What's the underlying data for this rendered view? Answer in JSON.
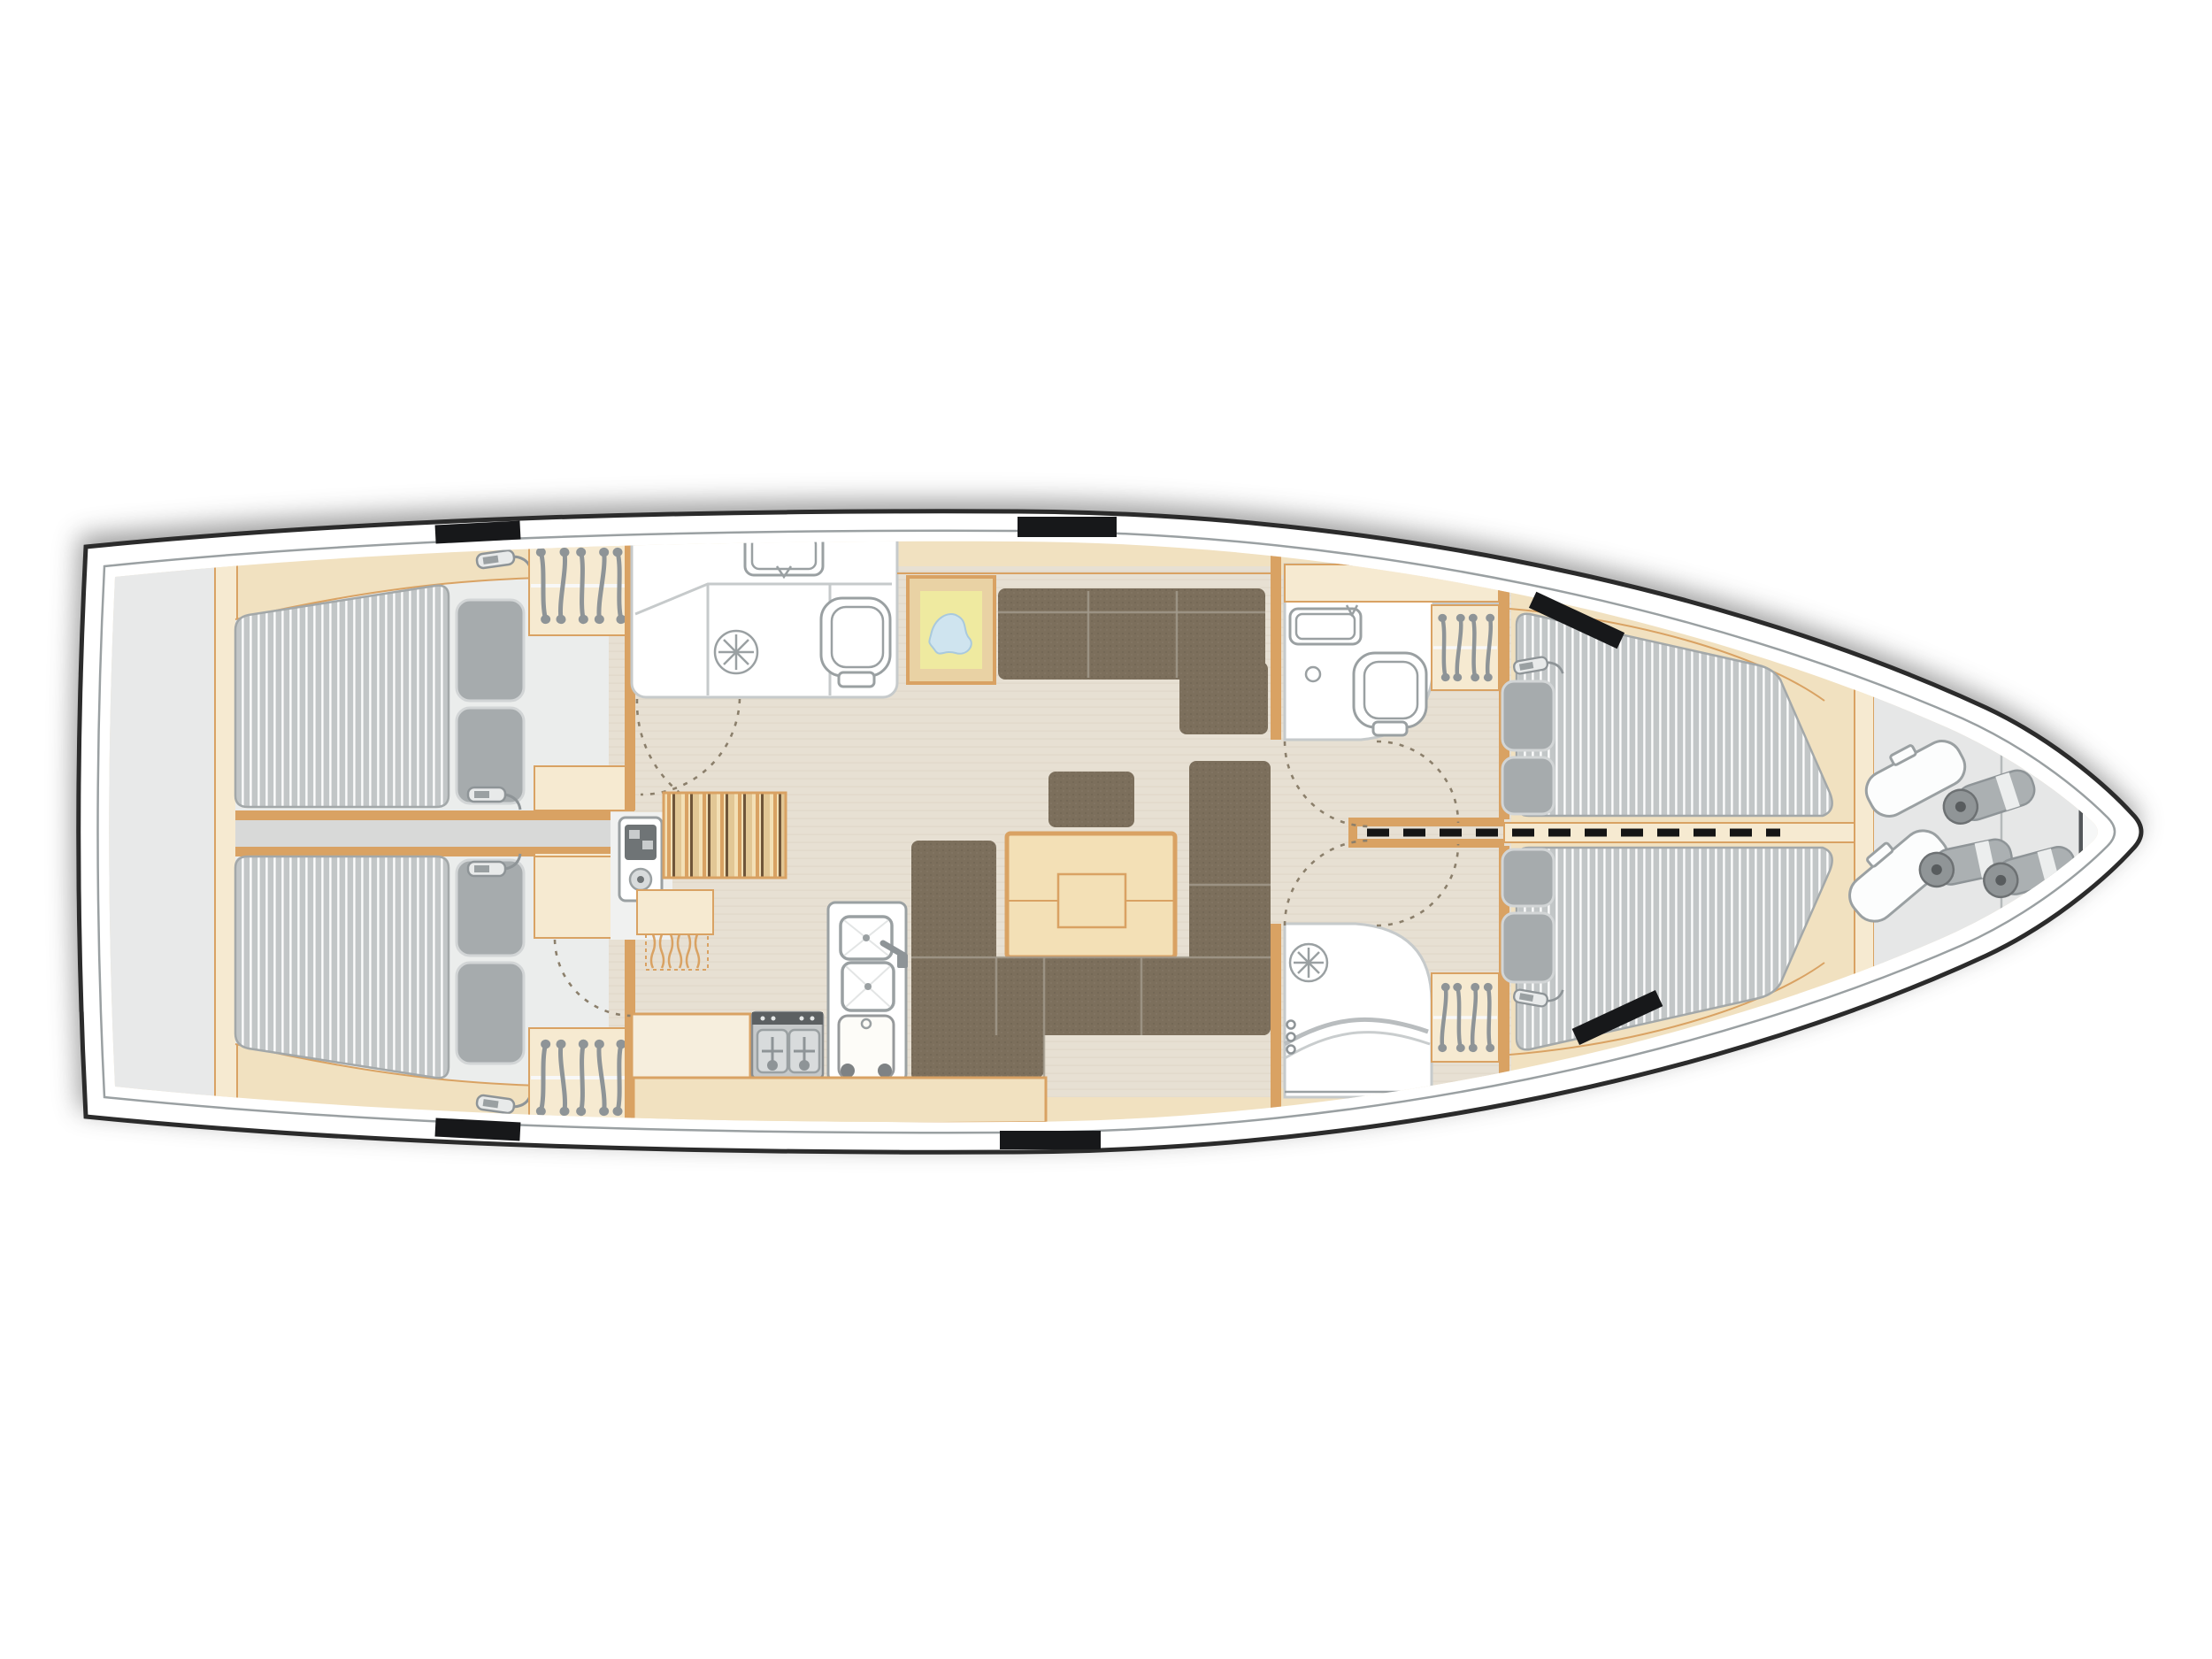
{
  "diagram": {
    "type": "floorplan",
    "subject": "sailing-yacht-interior-deck-plan",
    "view": "top-down",
    "orientation": "bow-right-stern-left"
  },
  "features": {
    "aft_double_cabins": 2,
    "aft_head_with_shower_and_toilet": 1,
    "forward_head_with_toilet": 1,
    "forward_shower_room": 1,
    "salon": {
      "l_sofa_sections": 3,
      "center_backrest": 1,
      "table": 1,
      "u_settee": 1,
      "framed_chart_picture": 1
    },
    "nav_station": {
      "chart_table": 1,
      "instrument_panel": 1,
      "seat": 1
    },
    "galley": {
      "stove_burners": 2,
      "sinks": 2,
      "refrigerator": 1,
      "counter": 1
    },
    "forward_v_berth_mattresses": 2,
    "pillows_total": 8,
    "wardrobes": {
      "aft_hangers_each": 5,
      "forward_hangers_each": 4
    },
    "sail_locker": {
      "sail_bags": 2,
      "fenders": 3
    },
    "deck_hatches": 6,
    "door_swing_arcs": 7,
    "centerline_dashed": true
  },
  "colors": {
    "background": "#ffffff",
    "hull_line": "#2b2b2b",
    "deck_line": "#9aa0a2",
    "wood_base": "#f1e1c0",
    "wood_light": "#f6ead1",
    "wood_trim": "#d9a263",
    "floor_beige": "#e7e0d3",
    "floor_grain": "#ddd5c6",
    "floor_cabin": "#ebedec",
    "walkway": "#d8d9d8",
    "gray_zone": "#e8e9e9",
    "mattress": "#c2c6c7",
    "mattress_stripe": "#ffffff",
    "mattress_edge": "#a3a8a9",
    "pillow": "#a6abad",
    "pillow_edge": "#d2d5d6",
    "upholstery": "#7c6f5c",
    "seam": "#a39b8d",
    "white_room": "#ffffff",
    "room_line": "#c6cacb",
    "fixture_line": "#9aa0a2",
    "metal": "#8e9497",
    "map_paper": "#efeaa0",
    "map_water": "#cfe4ef",
    "map_frame": "#e9d2a4",
    "hatch": "#17181a",
    "centerline": "#151515",
    "door_arc": "#8b7f6b",
    "table_wood": "#f3e0b6",
    "counter": "#f6eedd",
    "stove_dark": "#5c6062",
    "burner": "#d8dbdc",
    "locker_gray": "#e6e7e7",
    "bow_white": "#f6f7f7",
    "panel_dark": "#6f7476",
    "slat_dark": "#6f5539",
    "slat_mid": "#e2c795"
  }
}
